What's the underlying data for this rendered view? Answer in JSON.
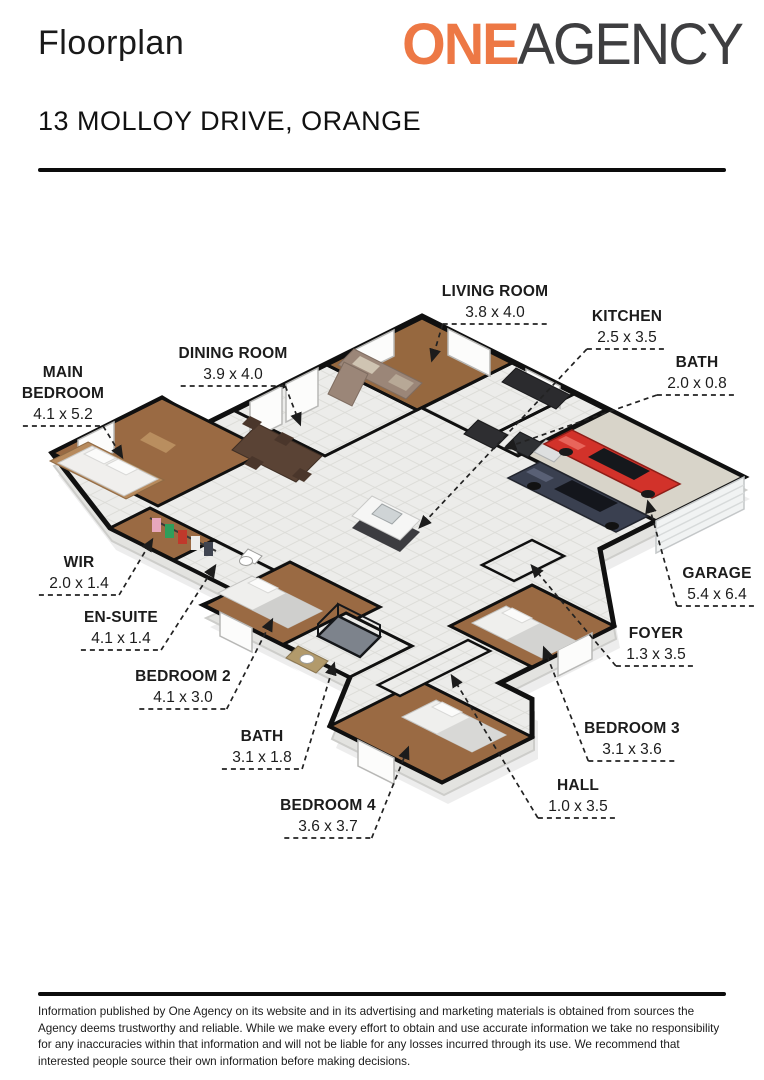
{
  "header": {
    "title": "Floorplan",
    "logo": {
      "one": "ONE",
      "agency": "AGENCY",
      "one_color": "#ED7845",
      "agency_color": "#3E3E40"
    },
    "address": "13 MOLLOY DRIVE, ORANGE"
  },
  "floorplan": {
    "rooms": [
      {
        "name": "LIVING ROOM",
        "dims": "3.8 x 4.0",
        "lx": 495,
        "ly": 296,
        "tx": 432,
        "ty": 360
      },
      {
        "name": "KITCHEN",
        "dims": "2.5 x 3.5",
        "lx": 627,
        "ly": 321,
        "tx": 420,
        "ty": 527
      },
      {
        "name": "BATH",
        "dims": "2.0 x 0.8",
        "lx": 697,
        "ly": 367,
        "tx": 505,
        "ty": 448
      },
      {
        "name": "DINING ROOM",
        "dims": "3.9 x 4.0",
        "lx": 233,
        "ly": 358,
        "tx": 300,
        "ty": 424
      },
      {
        "name": "MAIN\nBEDROOM",
        "dims": "4.1 x 5.2",
        "lx": 63,
        "ly": 377,
        "tx": 122,
        "ty": 457
      },
      {
        "name": "WIR",
        "dims": "2.0 x 1.4",
        "lx": 79,
        "ly": 567,
        "tx": 152,
        "ty": 540
      },
      {
        "name": "EN-SUITE",
        "dims": "4.1 x 1.4",
        "lx": 121,
        "ly": 622,
        "tx": 215,
        "ty": 566
      },
      {
        "name": "BEDROOM 2",
        "dims": "4.1 x 3.0",
        "lx": 183,
        "ly": 681,
        "tx": 272,
        "ty": 620
      },
      {
        "name": "BATH",
        "dims": "3.1 x 1.8",
        "lx": 262,
        "ly": 741,
        "tx": 334,
        "ty": 664
      },
      {
        "name": "BEDROOM 4",
        "dims": "3.6 x 3.7",
        "lx": 328,
        "ly": 810,
        "tx": 408,
        "ty": 748
      },
      {
        "name": "HALL",
        "dims": "1.0 x 3.5",
        "lx": 578,
        "ly": 790,
        "tx": 452,
        "ty": 676
      },
      {
        "name": "BEDROOM 3",
        "dims": "3.1 x 3.6",
        "lx": 632,
        "ly": 733,
        "tx": 544,
        "ty": 648
      },
      {
        "name": "FOYER",
        "dims": "1.3 x 3.5",
        "lx": 656,
        "ly": 638,
        "tx": 532,
        "ty": 566
      },
      {
        "name": "GARAGE",
        "dims": "5.4 x 6.4",
        "lx": 717,
        "ly": 578,
        "tx": 648,
        "ty": 502
      }
    ]
  },
  "footer": {
    "disclaimer": "Information published by One Agency on its website and in its advertising and marketing materials is obtained from sources the Agency deems trustworthy and reliable. While we make every effort to obtain and use accurate information we take no responsibility for any inaccuracies within that information and will not be liable for any losses incurred through its use. We recommend that interested people source their own information before making decisions."
  },
  "colors": {
    "accent_orange": "#ED7845",
    "logo_charcoal": "#3E3E40",
    "wall_black": "#101010",
    "floor_timber": "#9A6A43",
    "floor_tile": "#ECECEA",
    "garage_floor": "#D8D4C9",
    "car_red": "#D2322A",
    "car_dark": "#3A4050",
    "label_text": "#1C1C1C"
  }
}
